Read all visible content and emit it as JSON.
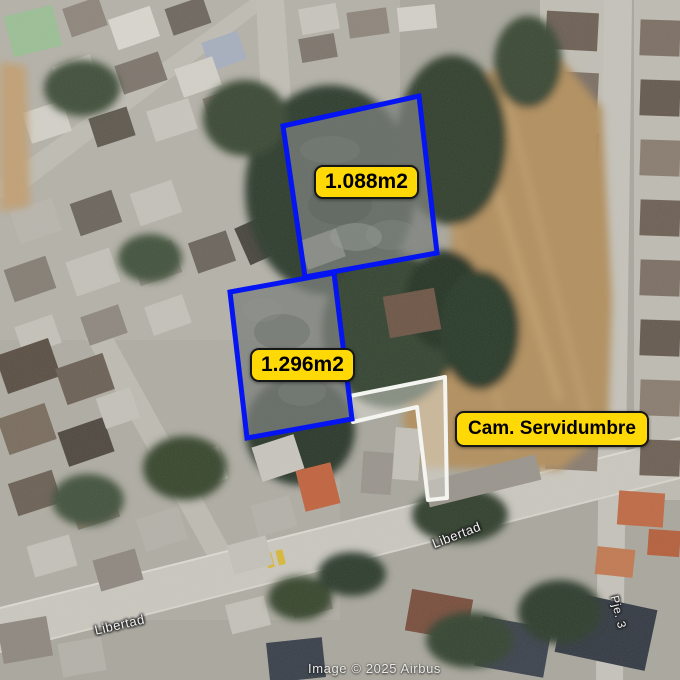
{
  "map": {
    "attribution": "Image © 2025 Airbus",
    "parcels": [
      {
        "area_label": "1.088m2",
        "outline_color": "#0414f2"
      },
      {
        "area_label": "1.296m2",
        "outline_color": "#0414f2"
      }
    ],
    "easement": {
      "label": "Cam. Servidumbre",
      "outline_color": "#f4f4f0"
    },
    "streets": [
      {
        "name": "Libertad"
      },
      {
        "name": "Libertad"
      },
      {
        "name": "Pje. 3"
      }
    ],
    "label_style": {
      "background": "#FFD905",
      "text_color": "#000000"
    }
  }
}
